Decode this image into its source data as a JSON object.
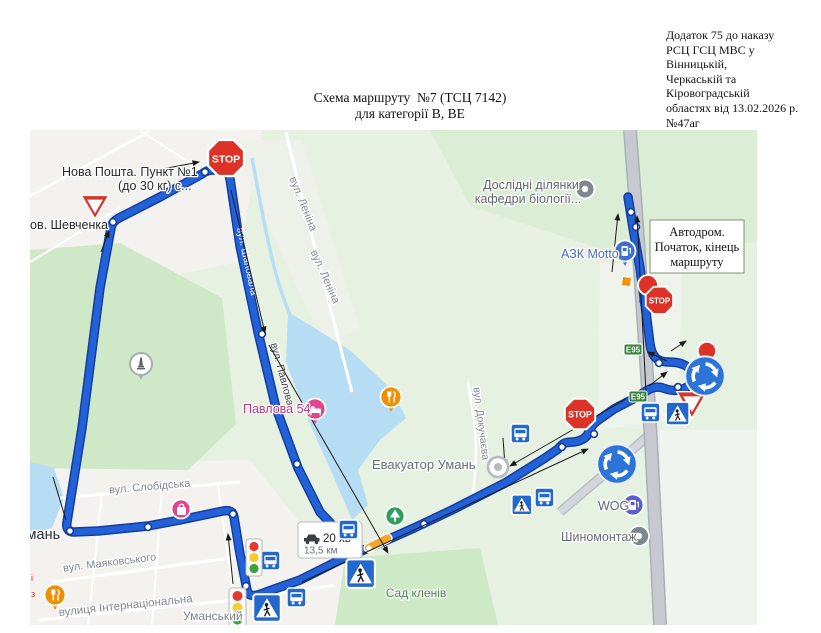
{
  "document": {
    "annotation_lines": [
      "Додаток 75 до наказу",
      "РСЦ ГСЦ МВС у Вінницькій,",
      "Черкаській та Кіровоградській",
      "областях від 13.02.2026 р. №47аг"
    ],
    "title_line1": "Схема маршруту  №7 (ТСЦ 7142)",
    "title_line2": "для категорії В, ВЕ"
  },
  "map": {
    "callout_autodrom": {
      "line1": "Автодром.",
      "line2": "Початок, кінець",
      "line3": "маршруту"
    },
    "route_info": {
      "duration": "20 хв",
      "distance": "13,5 км"
    },
    "sign_texts": {
      "stop": "STOP",
      "e95": "E95"
    },
    "poi_labels": {
      "nova_poshta_line1": "Нова Пошта. Пункт №1",
      "nova_poshta_line2": "(до 30 кг) с...",
      "shevchenka": "ов. Шевченка",
      "doslidni_line1": "Дослідні ділянки",
      "doslidni_line2": "кафедри біології...",
      "azk_motto": "АЗК Motto",
      "pavlova54": "Павлова 54",
      "evakuator": "Евакуатор Умань",
      "uman": "Умань",
      "wog": "WOG",
      "shynomontazh": "Шиномонтаж",
      "sad_kleniv": "Сад кленів",
      "umanskyi": "Уманський"
    },
    "street_labels": {
      "lenina": "вул. Леніна",
      "shapovala": "вул. Шаповала",
      "pavlova": "вул. Павлова",
      "dokuchaieva": "вул. Докучаєва",
      "slobidska": "вул. Слобідська",
      "maiakovskoho": "вул. Маяковського",
      "internatsionalna": "вулиця Інтернаціональна"
    },
    "edge_fragments": {
      "a": "і",
      "b": "з"
    },
    "colors": {
      "route_blue": "#2361d9",
      "route_casing": "#123f9e",
      "sign_blue": "#2268cd",
      "stop_red": "#dd3327",
      "e95_green": "#35823a",
      "water": "#b7ddf4",
      "park_green": "#cfe8c8",
      "urban": "#f4f2ee",
      "map_bg": "#e7f1e2",
      "highway_gray": "#c6cad0",
      "pin_pink": "#e0468e",
      "pin_orange": "#ef8f06",
      "pin_gas_blue": "#3f6fd1",
      "pin_wog": "#5a5fd0",
      "pin_gray": "#7f868d",
      "pin_green": "#2f9e5f",
      "marker_orange": "#f5a623"
    }
  }
}
